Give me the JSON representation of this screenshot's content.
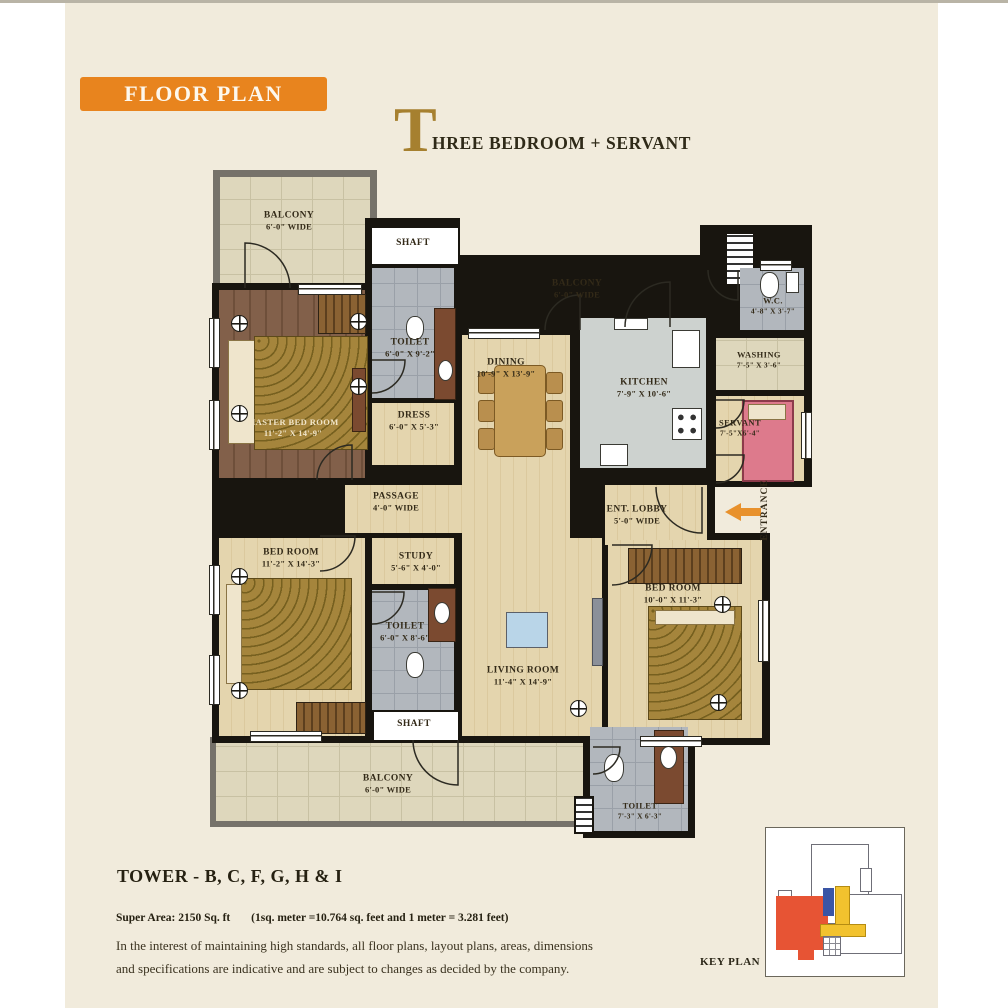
{
  "header": {
    "banner": "FLOOR PLAN",
    "title_initial": "T",
    "title_rest": "HREE BEDROOM + SERVANT"
  },
  "rooms": {
    "balcony_tl": {
      "name": "BALCONY",
      "dims": "6'-0\" WIDE"
    },
    "shaft_top": {
      "name": "SHAFT"
    },
    "toilet_top": {
      "name": "TOILET",
      "dims": "6'-0\" X 9'-2\""
    },
    "master": {
      "name": "MASTER BED ROOM",
      "dims": "11'-2\" X 14'-9\""
    },
    "dress": {
      "name": "DRESS",
      "dims": "6'-0\" X 5'-3\""
    },
    "balcony_top": {
      "name": "BALCONY",
      "dims": "6'-0\" WIDE"
    },
    "dining": {
      "name": "DINING",
      "dims": "10'-9\" X 13'-9\""
    },
    "kitchen": {
      "name": "KITCHEN",
      "dims": "7'-9\" X 10'-6\""
    },
    "wc": {
      "name": "W.C.",
      "dims": "4'-8\" X 3'-7\""
    },
    "washing": {
      "name": "WASHING",
      "dims": "7'-5\" X 3'-6\""
    },
    "servant": {
      "name": "SERVANT",
      "dims": "7'-5\"X6'-4\""
    },
    "ent_lobby": {
      "name": "ENT. LOBBY",
      "dims": "5'-0\" WIDE"
    },
    "entrance": {
      "name": "ENTRANCE"
    },
    "passage": {
      "name": "PASSAGE",
      "dims": "4'-0\" WIDE"
    },
    "bedroom_left": {
      "name": "BED ROOM",
      "dims": "11'-2\" X 14'-3\""
    },
    "study": {
      "name": "STUDY",
      "dims": "5'-6\" X 4'-0\""
    },
    "toilet_mid": {
      "name": "TOILET",
      "dims": "6'-0\" X 8'-6\""
    },
    "living": {
      "name": "LIVING ROOM",
      "dims": "11'-4\" X 14'-9\""
    },
    "bedroom_right": {
      "name": "BED ROOM",
      "dims": "10'-0\" X 11'-3\""
    },
    "shaft_bottom": {
      "name": "SHAFT"
    },
    "balcony_bottom": {
      "name": "BALCONY",
      "dims": "6'-0\" WIDE"
    },
    "toilet_bottom": {
      "name": "TOILET",
      "dims": "7'-3\" X 6'-3\""
    }
  },
  "footer": {
    "tower": "TOWER - B, C, F, G, H & I",
    "super_area": "Super Area: 2150 Sq. ft",
    "conversion": "(1sq. meter =10.764 sq. feet and 1 meter = 3.281 feet)",
    "disclaimer1": "In the interest of maintaining high standards, all floor plans, layout plans, areas, dimensions",
    "disclaimer2": "and specifications are indicative and are subject to changes as decided by the company."
  },
  "key_plan": {
    "label": "KEY PLAN"
  },
  "colors": {
    "accent_orange": "#E8841E",
    "title_gold": "#A6802F",
    "key_red": "#E75434",
    "key_blue": "#3A55A5",
    "key_yellow": "#F2C22E"
  }
}
